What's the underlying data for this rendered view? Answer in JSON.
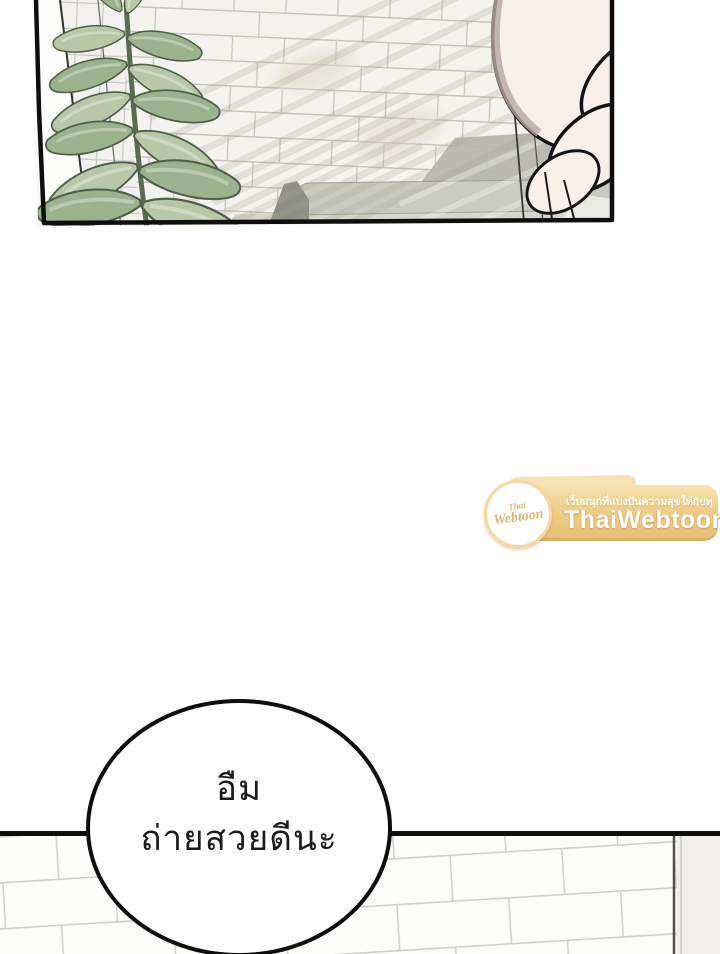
{
  "page_type": "webtoon-comic-page",
  "bubble": {
    "line1": "อืม",
    "line2": "ถ่ายสวยดีนะ"
  },
  "watermark": {
    "logo_top": "Thai",
    "logo_bottom": "Webtoon",
    "tagline": "เว็บสนุกที่แบ่งปันความสุขให้กับทุกคน",
    "brand": "ThaiWebtoon",
    "colors": {
      "banner": "#eeca83",
      "banner_light": "#f6e2b2",
      "banner_shadow": "#d9ae6a",
      "text": "#ffffff",
      "logo_text": "#ddb674"
    }
  },
  "colors": {
    "paper": "#ffffff",
    "ink": "#0e0e0e",
    "tile_top": "#f4f3ef",
    "grout_top": "#c7c6be",
    "tile_bottom": "#fcfcfa",
    "grout_bottom": "#d0d0cb",
    "leaf_light": "#b9c7a8",
    "leaf_mid": "#9cb28e",
    "leaf_dark": "#4e6047",
    "skin": "#f9f0ea",
    "skin_shadow": "#b7a7a2",
    "sofa_light": "#c9cac1",
    "sofa_dark": "#8e8f88",
    "wall_plain": "#f0efeb"
  }
}
